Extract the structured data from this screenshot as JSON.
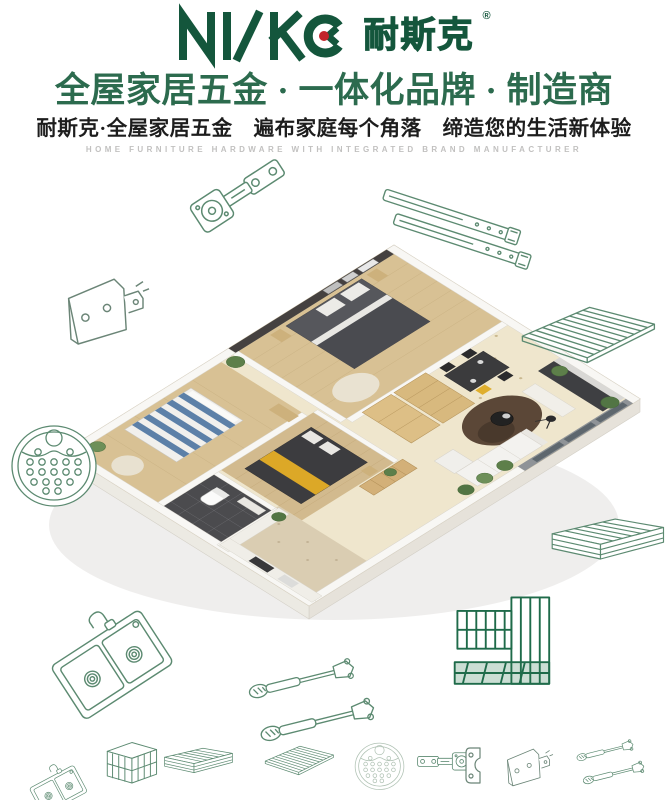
{
  "brand": {
    "logo_latin": "NISKO",
    "logo_cn": "耐斯克",
    "registered": "®",
    "headline": "全屋家居五金 · 一体化品牌 · 制造商",
    "subheadline": "耐斯克·全屋家居五金　遍布家庭每个角落　缔造您的生活新体验",
    "tagline_en": "HOME FURNITURE HARDWARE WITH INTEGRATED BRAND MANUFACTURER"
  },
  "colors": {
    "brand_green": "#14563c",
    "headline_green": "#2c6b4e",
    "accent_red": "#c2242a",
    "lineart_green": "#5c8a71",
    "lineart_dark_green": "#1f6b4a",
    "lineart_gray_green": "#6b8577",
    "lineart_light_green": "#b0c2b4",
    "tagline_gray": "#c2c1c0",
    "text_dark": "#1d1d1d"
  },
  "illustrations": {
    "center": "isometric-apartment-floorplan-render",
    "around": [
      "cabinet-hinge",
      "drawer-slide-rails",
      "corner-bracket",
      "wire-shelf",
      "round-perforated-tray",
      "pull-out-basket",
      "double-bowl-kitchen-sink",
      "gas-lift-struts",
      "wire-organizer-rack"
    ],
    "bottom_row": [
      "kitchen-sink",
      "wire-box-basket",
      "drawer-basket",
      "wire-shelf",
      "round-perforated-tray",
      "cabinet-hinge",
      "mounting-bracket",
      "corner-bracket",
      "gas-lift-struts"
    ]
  }
}
